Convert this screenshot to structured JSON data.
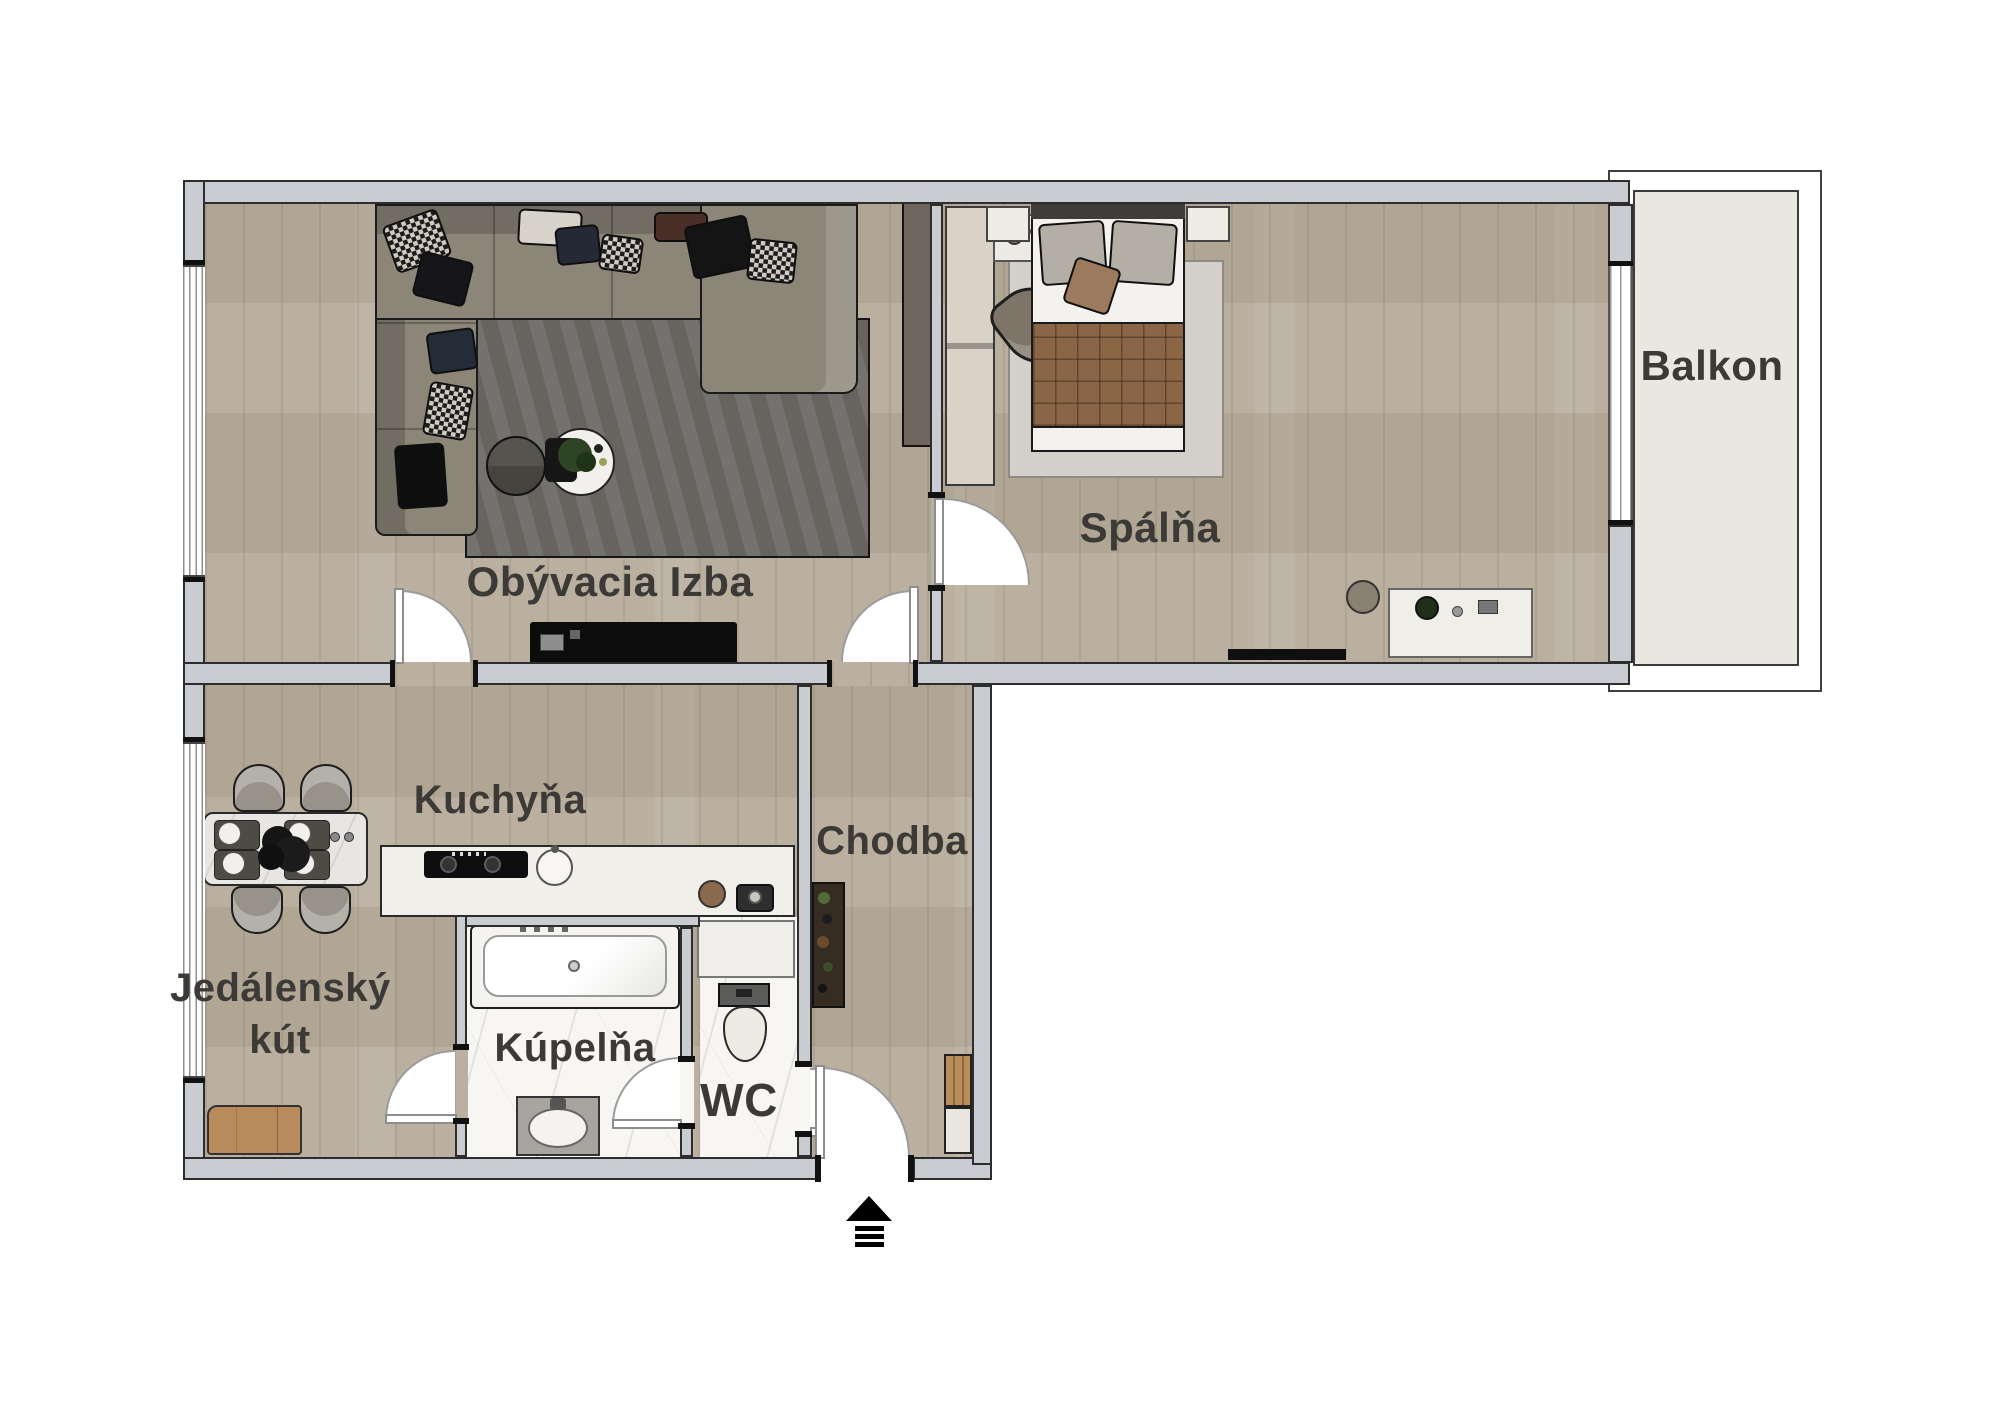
{
  "palette": {
    "wall": "#c9cdd2",
    "wood_floor": "#b7ac9b",
    "marble_floor": "#f7f6f3",
    "balcony_floor": "#eae7e1",
    "label_text": "#3c3a36",
    "outline": "#2d2d2d",
    "rug": "#6d6a66",
    "accent_wood_cabinet": "#b98e58"
  },
  "rooms": [
    {
      "id": "living-room",
      "label": "Obývacia Izba"
    },
    {
      "id": "bedroom",
      "label": "Spálňa"
    },
    {
      "id": "balcony",
      "label": "Balkon"
    },
    {
      "id": "kitchen",
      "label": "Kuchyňa"
    },
    {
      "id": "hallway",
      "label": "Chodba"
    },
    {
      "id": "dining-nook",
      "label_line1": "Jedálenský",
      "label_line2": "kút"
    },
    {
      "id": "bathroom",
      "label": "Kúpelňa"
    },
    {
      "id": "wc",
      "label": "WC"
    }
  ],
  "icons": [
    {
      "id": "entrance-arrow",
      "meaning": "entrance direction arrow pointing up"
    }
  ]
}
